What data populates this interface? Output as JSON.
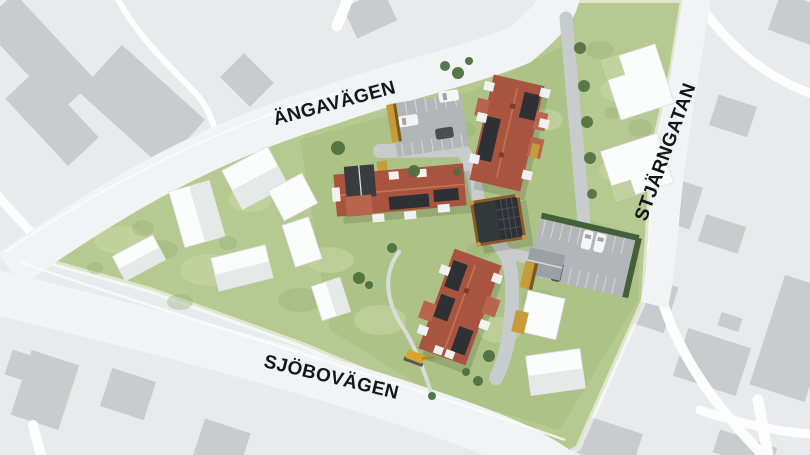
{
  "streets": {
    "top": {
      "label": "ÄNGAVÄGEN"
    },
    "right": {
      "label": "STJÄRNGATAN"
    },
    "bottom": {
      "label": "SJÖBOVÄGEN"
    }
  },
  "palette": {
    "map_background": "#e9eaec",
    "map_building": "#c9cbce",
    "map_road": "#ffffff",
    "site_road": "#f2f3f4",
    "grass": "#b6c991",
    "grass_light": "#ccd9a6",
    "grass_dark": "#95b172",
    "asphalt": "#b3b6b8",
    "inner_road": "#c9cccd",
    "footpath": "#dadcdc",
    "roof_red": "#a9543f",
    "roof_red_light": "#b8654e",
    "solar_panel": "#2d3134",
    "carport_frame": "#8a5a2b",
    "shed_yellow": "#c79b3a",
    "white_building": "#fbfcfc",
    "garage_gray": "#9aa0a3",
    "tree_green": "#4f7040",
    "hedge_green": "#44603a",
    "car_white": "#f4f5f6",
    "car_dark": "#4a4e50",
    "label_color": "#161616"
  }
}
